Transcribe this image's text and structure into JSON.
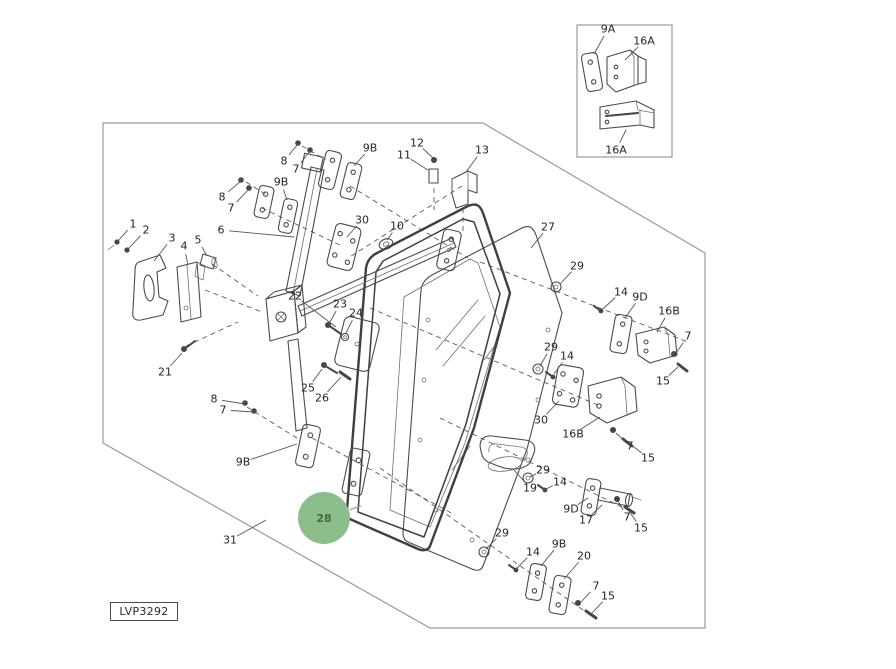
{
  "meta": {
    "figure_code": "LVP3292",
    "highlighted_part": "28",
    "diagram_type": "exploded-parts-diagram"
  },
  "colors": {
    "line": "#4b4b4b",
    "border": "#9a9a9a",
    "label": "#262626",
    "highlight_fill": "#8cbe8c",
    "highlight_text": "#3e6a40"
  },
  "callouts": [
    {
      "t": "9A",
      "x": 608,
      "y": 29,
      "tx": 594,
      "ty": 54
    },
    {
      "t": "16A",
      "x": 644,
      "y": 41,
      "tx": 625,
      "ty": 60
    },
    {
      "t": "16A",
      "x": 616,
      "y": 150,
      "tx": 626,
      "ty": 130
    },
    {
      "t": "8",
      "x": 222,
      "y": 197,
      "tx": 241,
      "ty": 181
    },
    {
      "t": "7",
      "x": 231,
      "y": 208,
      "tx": 249,
      "ty": 189
    },
    {
      "t": "8",
      "x": 284,
      "y": 161,
      "tx": 298,
      "ty": 144
    },
    {
      "t": "7",
      "x": 296,
      "y": 169,
      "tx": 310,
      "ty": 151
    },
    {
      "t": "9B",
      "x": 281,
      "y": 182,
      "tx": 287,
      "ty": 200
    },
    {
      "t": "9B",
      "x": 370,
      "y": 148,
      "tx": 354,
      "ty": 166
    },
    {
      "t": "12",
      "x": 417,
      "y": 143,
      "tx": 433,
      "ty": 158
    },
    {
      "t": "11",
      "x": 404,
      "y": 155,
      "tx": 428,
      "ty": 170
    },
    {
      "t": "13",
      "x": 482,
      "y": 150,
      "tx": 466,
      "ty": 172
    },
    {
      "t": "1",
      "x": 133,
      "y": 224,
      "tx": 118,
      "ty": 241
    },
    {
      "t": "2",
      "x": 146,
      "y": 230,
      "tx": 128,
      "ty": 249
    },
    {
      "t": "3",
      "x": 172,
      "y": 238,
      "tx": 154,
      "ty": 261
    },
    {
      "t": "4",
      "x": 184,
      "y": 246,
      "tx": 188,
      "ty": 265
    },
    {
      "t": "5",
      "x": 198,
      "y": 240,
      "tx": 207,
      "ty": 256
    },
    {
      "t": "6",
      "x": 221,
      "y": 230,
      "tx": 294,
      "ty": 237
    },
    {
      "t": "30",
      "x": 362,
      "y": 220,
      "tx": 347,
      "ty": 237
    },
    {
      "t": "10",
      "x": 397,
      "y": 226,
      "tx": 387,
      "ty": 240
    },
    {
      "t": "27",
      "x": 548,
      "y": 227,
      "tx": 531,
      "ty": 248
    },
    {
      "t": "29",
      "x": 577,
      "y": 266,
      "tx": 560,
      "ty": 284
    },
    {
      "t": "14",
      "x": 621,
      "y": 292,
      "tx": 603,
      "ty": 309
    },
    {
      "t": "9D",
      "x": 640,
      "y": 297,
      "tx": 625,
      "ty": 318
    },
    {
      "t": "16B",
      "x": 669,
      "y": 311,
      "tx": 657,
      "ty": 332
    },
    {
      "t": "7",
      "x": 688,
      "y": 336,
      "tx": 676,
      "ty": 353
    },
    {
      "t": "15",
      "x": 663,
      "y": 381,
      "tx": 678,
      "ty": 367
    },
    {
      "t": "22",
      "x": 295,
      "y": 296,
      "tx": 336,
      "ty": 327
    },
    {
      "t": "23",
      "x": 340,
      "y": 304,
      "tx": 330,
      "ty": 322
    },
    {
      "t": "24",
      "x": 356,
      "y": 313,
      "tx": 346,
      "ty": 333
    },
    {
      "t": "21",
      "x": 165,
      "y": 372,
      "tx": 182,
      "ty": 353
    },
    {
      "t": "25",
      "x": 308,
      "y": 388,
      "tx": 322,
      "ty": 369
    },
    {
      "t": "26",
      "x": 322,
      "y": 398,
      "tx": 341,
      "ty": 377
    },
    {
      "t": "29",
      "x": 551,
      "y": 347,
      "tx": 540,
      "ty": 366
    },
    {
      "t": "14",
      "x": 567,
      "y": 356,
      "tx": 554,
      "ty": 374
    },
    {
      "t": "30",
      "x": 541,
      "y": 420,
      "tx": 559,
      "ty": 401
    },
    {
      "t": "16B",
      "x": 573,
      "y": 434,
      "tx": 600,
      "ty": 417
    },
    {
      "t": "7",
      "x": 630,
      "y": 446,
      "tx": 616,
      "ty": 433
    },
    {
      "t": "15",
      "x": 648,
      "y": 458,
      "tx": 629,
      "ty": 443
    },
    {
      "t": "8",
      "x": 214,
      "y": 399,
      "tx": 245,
      "ty": 404
    },
    {
      "t": "7",
      "x": 223,
      "y": 410,
      "tx": 254,
      "ty": 412
    },
    {
      "t": "9B",
      "x": 243,
      "y": 462,
      "tx": 297,
      "ty": 444
    },
    {
      "t": "29",
      "x": 543,
      "y": 470,
      "tx": 530,
      "ty": 477
    },
    {
      "t": "14",
      "x": 560,
      "y": 482,
      "tx": 546,
      "ty": 489
    },
    {
      "t": "19",
      "x": 530,
      "y": 488,
      "tx": 513,
      "ty": 469
    },
    {
      "t": "9D",
      "x": 571,
      "y": 509,
      "tx": 588,
      "ty": 498
    },
    {
      "t": "17",
      "x": 586,
      "y": 520,
      "tx": 602,
      "ty": 505
    },
    {
      "t": "7",
      "x": 627,
      "y": 517,
      "tx": 618,
      "ty": 501
    },
    {
      "t": "15",
      "x": 641,
      "y": 528,
      "tx": 629,
      "ty": 511
    },
    {
      "t": "28",
      "x": 324,
      "y": 518,
      "tx": 361,
      "ty": 506,
      "hl": true
    },
    {
      "t": "31",
      "x": 230,
      "y": 540,
      "tx": 266,
      "ty": 520
    },
    {
      "t": "29",
      "x": 502,
      "y": 533,
      "tx": 486,
      "ty": 549
    },
    {
      "t": "14",
      "x": 533,
      "y": 552,
      "tx": 517,
      "ty": 568
    },
    {
      "t": "9B",
      "x": 559,
      "y": 544,
      "tx": 541,
      "ty": 566
    },
    {
      "t": "20",
      "x": 584,
      "y": 556,
      "tx": 564,
      "ty": 579
    },
    {
      "t": "7",
      "x": 596,
      "y": 586,
      "tx": 581,
      "ty": 602
    },
    {
      "t": "15",
      "x": 608,
      "y": 596,
      "tx": 592,
      "ty": 613
    }
  ]
}
